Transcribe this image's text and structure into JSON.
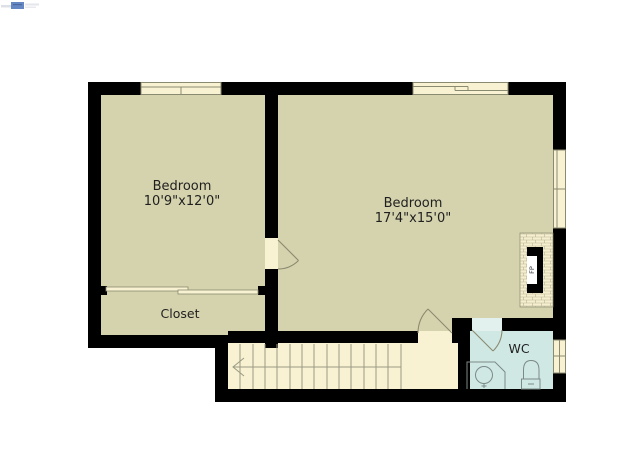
{
  "page": {
    "background": "#ffffff"
  },
  "watermark": {
    "icon": "listing-watermark-logo",
    "accent_color": "#4a72b8"
  },
  "floorplan": {
    "colors": {
      "wall": "#000000",
      "room_floor": "#d5d3ad",
      "hall_floor": "#f8f2d2",
      "wc_floor": "#cfe8e4",
      "window_fill": "#f8f2d2",
      "line": "#8a8a70",
      "stair_line": "#9a9a84",
      "text": "#1f1f1f"
    },
    "rooms": {
      "bedroom_left": {
        "label": "Bedroom",
        "dimensions": "10'9\"x12'0\""
      },
      "bedroom_right": {
        "label": "Bedroom",
        "dimensions": "17'4\"x15'0\""
      },
      "closet": {
        "label": "Closet"
      },
      "wc": {
        "label": "WC"
      }
    },
    "fixtures": {
      "fireplace": {
        "label": "FP"
      }
    }
  }
}
